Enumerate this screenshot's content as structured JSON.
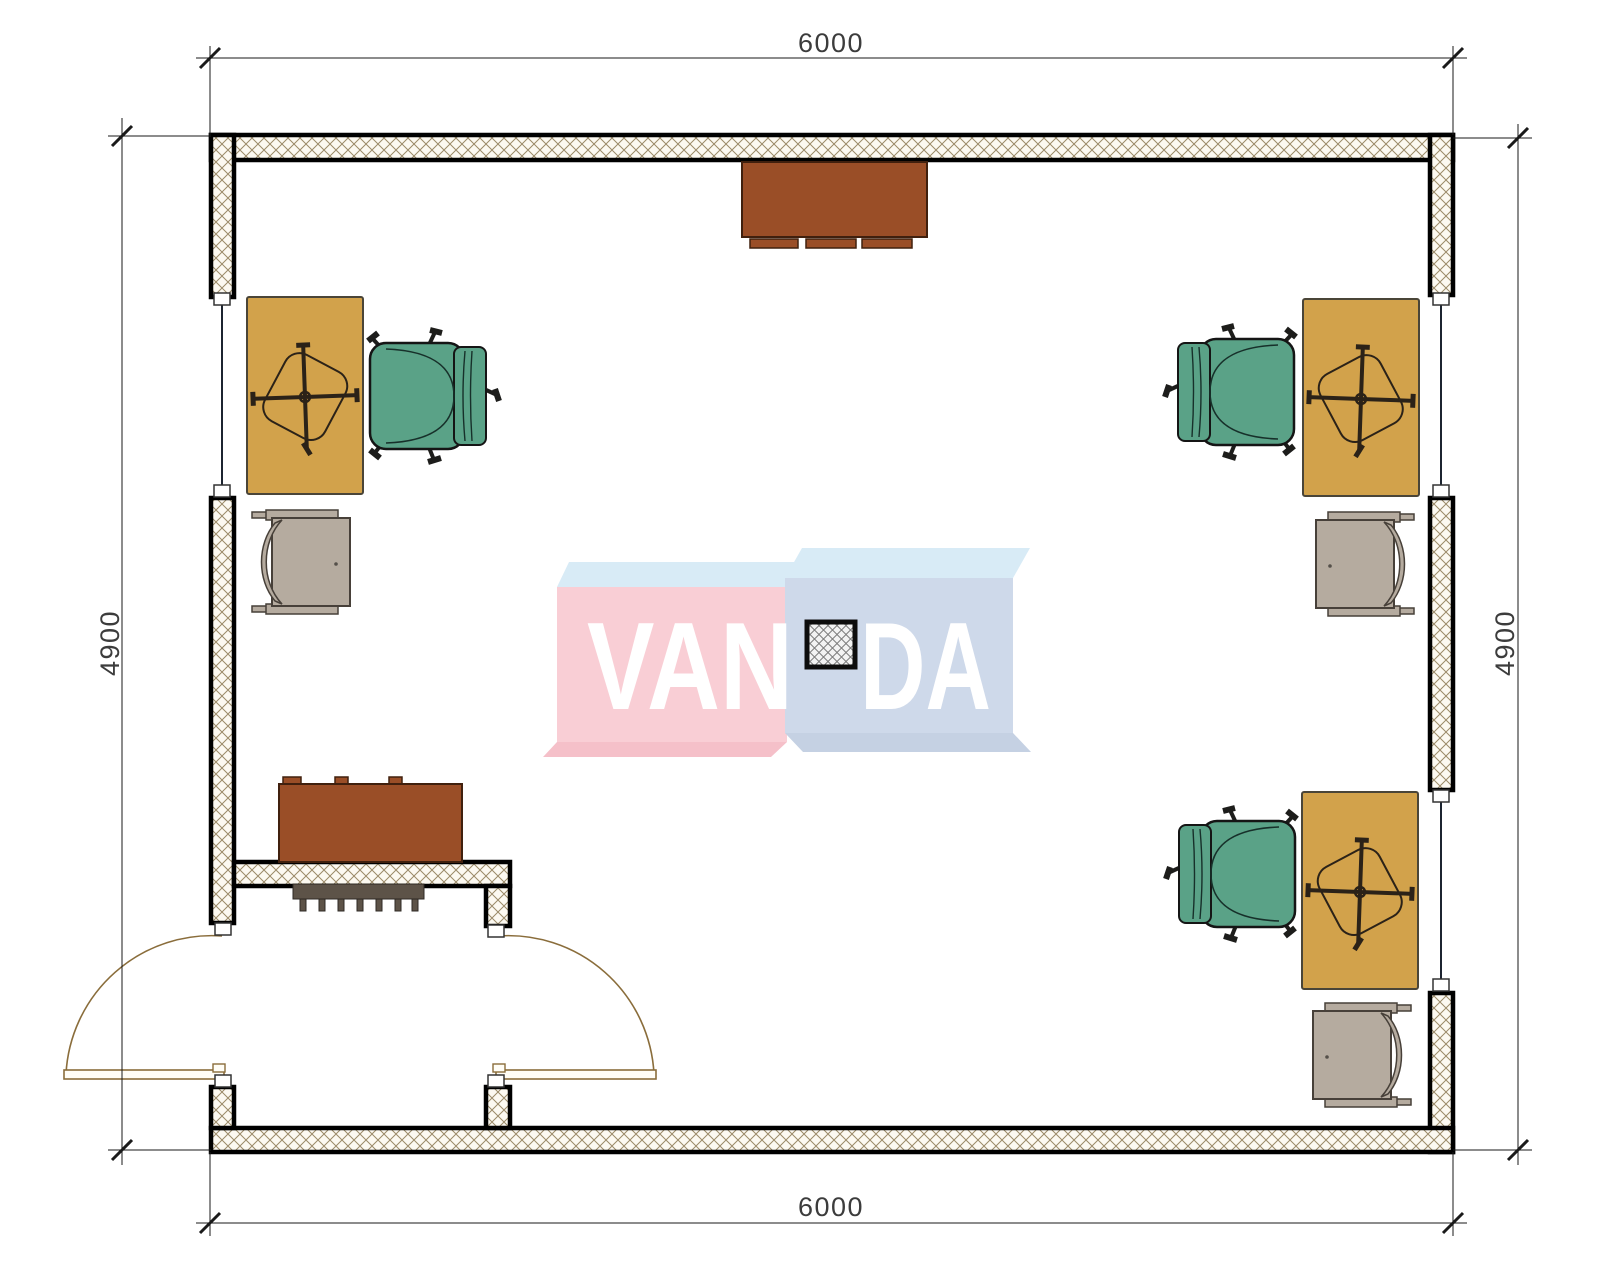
{
  "drawing": {
    "type": "office floor plan",
    "room_width_label": "6000",
    "room_depth_label": "4900"
  },
  "dimensions": {
    "top": "6000",
    "bottom": "6000",
    "left": "4900",
    "right": "4900"
  },
  "watermark": {
    "left": "VAN",
    "right": "DA",
    "full": "VANDA"
  },
  "colors": {
    "wall_border": "#000000",
    "hatch_line": "#9b8a68",
    "hatch_bg": "#fcf9f1",
    "desk": "#d2a24b",
    "chair_green": "#5aa287",
    "chair_gray": "#b5ab9f",
    "cabinet": "#9a4e27",
    "radiator": "#5d5348",
    "door": "#8a6d3b",
    "window_line": "#1c2430",
    "dim_line": "#1a1a1a",
    "logo_pink": "#f9ccd3",
    "logo_blue": "#ccd7e9",
    "logo_top": "#d6eaf6",
    "logo_pink_dark": "#f5bdc7",
    "logo_blue_dark": "#c2cfe2"
  },
  "furniture": {
    "desks": 3,
    "task_chairs_green": 3,
    "side_chairs_gray": 3,
    "cabinets": 2,
    "radiators": 1,
    "center_stands": 1,
    "entry_door_leaves": 2,
    "windows": 3
  }
}
